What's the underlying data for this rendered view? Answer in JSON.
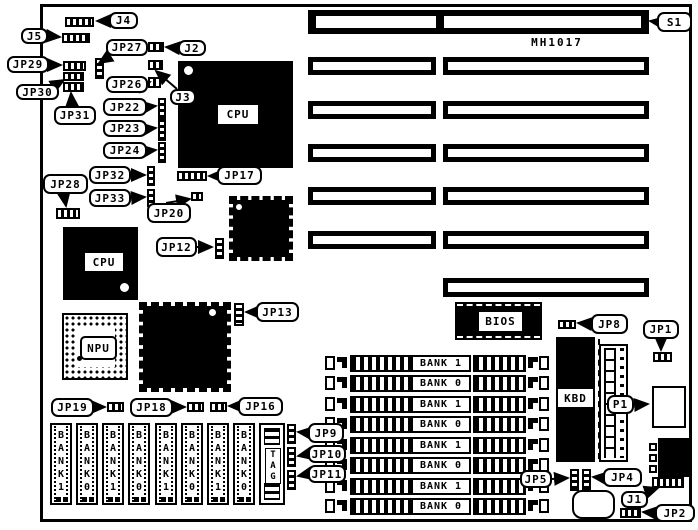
{
  "figure": {
    "type": "motherboard-jumper-location-diagram",
    "board_model": "MH1017"
  },
  "chips": {
    "cpu_main": "CPU",
    "cpu_alt": "CPU",
    "npu": "NPU",
    "bios": "BIOS",
    "kbd": "KBD",
    "tag": "TAG"
  },
  "memory": {
    "simm_banks": [
      "BANK 1",
      "BANK 0",
      "BANK 1",
      "BANK 0",
      "BANK 1",
      "BANK 0",
      "BANK 1",
      "BANK 0"
    ],
    "dip_banks": [
      "BANK1",
      "BANK0",
      "BANK1",
      "BANK0",
      "BANK1",
      "BANK0",
      "BANK1",
      "BANK0"
    ]
  },
  "callouts": [
    {
      "id": "j4",
      "label": "J4"
    },
    {
      "id": "j5",
      "label": "J5"
    },
    {
      "id": "jp29",
      "label": "JP29"
    },
    {
      "id": "jp30",
      "label": "JP30"
    },
    {
      "id": "jp31",
      "label": "JP31"
    },
    {
      "id": "jp27",
      "label": "JP27"
    },
    {
      "id": "j2",
      "label": "J2"
    },
    {
      "id": "jp26",
      "label": "JP26"
    },
    {
      "id": "j3",
      "label": "J3"
    },
    {
      "id": "jp22",
      "label": "JP22"
    },
    {
      "id": "jp23",
      "label": "JP23"
    },
    {
      "id": "jp24",
      "label": "JP24"
    },
    {
      "id": "jp32",
      "label": "JP32"
    },
    {
      "id": "jp33",
      "label": "JP33"
    },
    {
      "id": "jp20",
      "label": "JP20"
    },
    {
      "id": "jp17",
      "label": "JP17"
    },
    {
      "id": "jp28",
      "label": "JP28"
    },
    {
      "id": "jp12",
      "label": "JP12"
    },
    {
      "id": "jp13",
      "label": "JP13"
    },
    {
      "id": "jp19",
      "label": "JP19"
    },
    {
      "id": "jp18",
      "label": "JP18"
    },
    {
      "id": "jp16",
      "label": "JP16"
    },
    {
      "id": "jp9",
      "label": "JP9"
    },
    {
      "id": "jp10",
      "label": "JP10"
    },
    {
      "id": "jp11",
      "label": "JP11"
    },
    {
      "id": "s1",
      "label": "S1"
    },
    {
      "id": "jp8",
      "label": "JP8"
    },
    {
      "id": "jp1",
      "label": "JP1"
    },
    {
      "id": "p1",
      "label": "P1"
    },
    {
      "id": "jp5",
      "label": "JP5"
    },
    {
      "id": "jp4",
      "label": "JP4"
    },
    {
      "id": "j1",
      "label": "J1"
    },
    {
      "id": "jp2",
      "label": "JP2"
    }
  ],
  "colors": {
    "ink": "#000000",
    "paper": "#ffffff"
  }
}
